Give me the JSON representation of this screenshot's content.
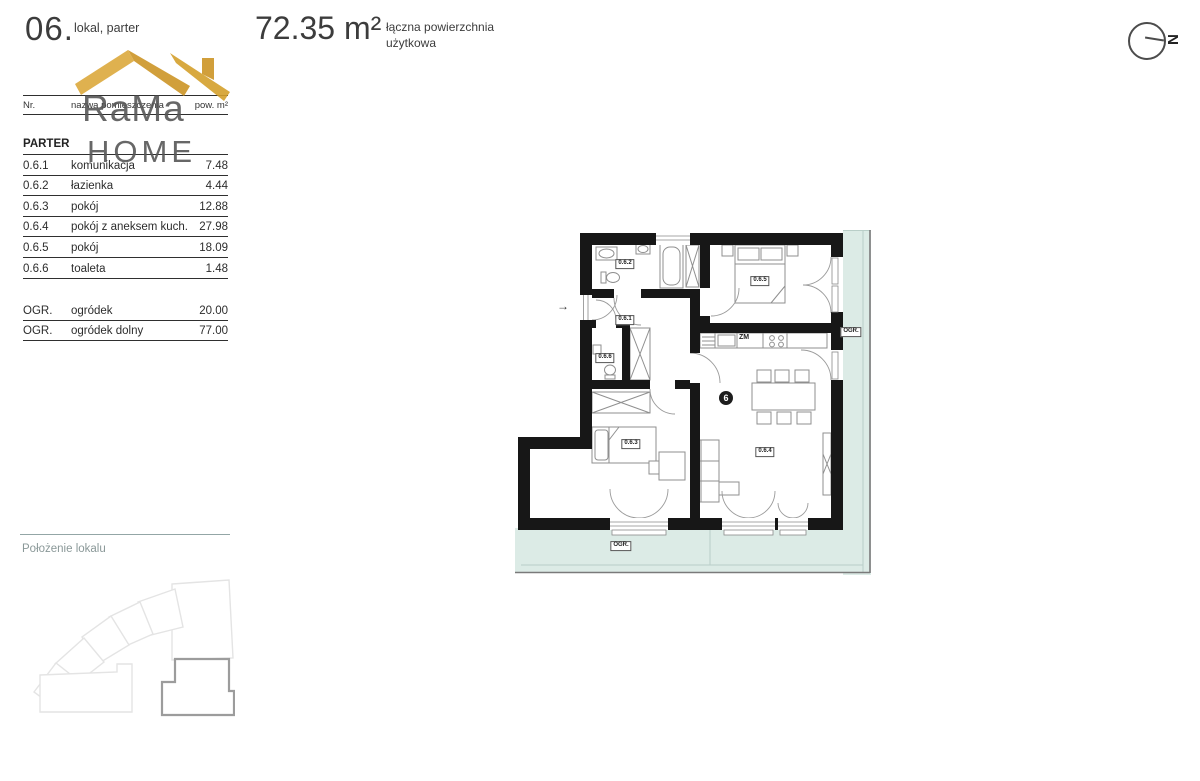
{
  "header": {
    "unit_number": "06.",
    "unit_type": "lokal, parter",
    "area_value": "72.35 m²",
    "area_label_line1": "łączna powierzchnia",
    "area_label_line2": "użytkowa"
  },
  "compass": {
    "north_label": "N"
  },
  "logo": {
    "line1": "RaMa",
    "line2": "HOME"
  },
  "table": {
    "columns": {
      "nr": "Nr.",
      "name": "nazwa pomieszczenia",
      "area": "pow. m²"
    },
    "section": "PARTER",
    "rows": [
      {
        "nr": "0.6.1",
        "name": "komunikacja",
        "area": "7.48"
      },
      {
        "nr": "0.6.2",
        "name": "łazienka",
        "area": "4.44"
      },
      {
        "nr": "0.6.3",
        "name": "pokój",
        "area": "12.88"
      },
      {
        "nr": "0.6.4",
        "name": "pokój z aneksem kuch.",
        "area": "27.98"
      },
      {
        "nr": "0.6.5",
        "name": "pokój",
        "area": "18.09"
      },
      {
        "nr": "0.6.6",
        "name": "toaleta",
        "area": "1.48"
      }
    ],
    "garden_rows": [
      {
        "nr": "OGR.",
        "name": "ogródek",
        "area": "20.00"
      },
      {
        "nr": "OGR.",
        "name": "ogródek dolny",
        "area": "77.00"
      }
    ]
  },
  "location": {
    "title": "Położenie lokalu"
  },
  "plan": {
    "labels": {
      "hall": "0.6.1",
      "bathroom": "0.6.2",
      "room3": "0.6.3",
      "living": "0.6.4",
      "bedroom": "0.6.5",
      "toilet": "0.6.6",
      "garden_bottom": "OGR.",
      "garden_right": "OGR.",
      "dishwasher": "ZM",
      "unit_marker": "6",
      "entry_arrow": "→"
    }
  },
  "colors": {
    "gold": "#D9A93D",
    "gold_dark": "#CD9526",
    "garden": "#DCEBE6",
    "wall": "#171717",
    "teal_text": "#8A9898"
  }
}
